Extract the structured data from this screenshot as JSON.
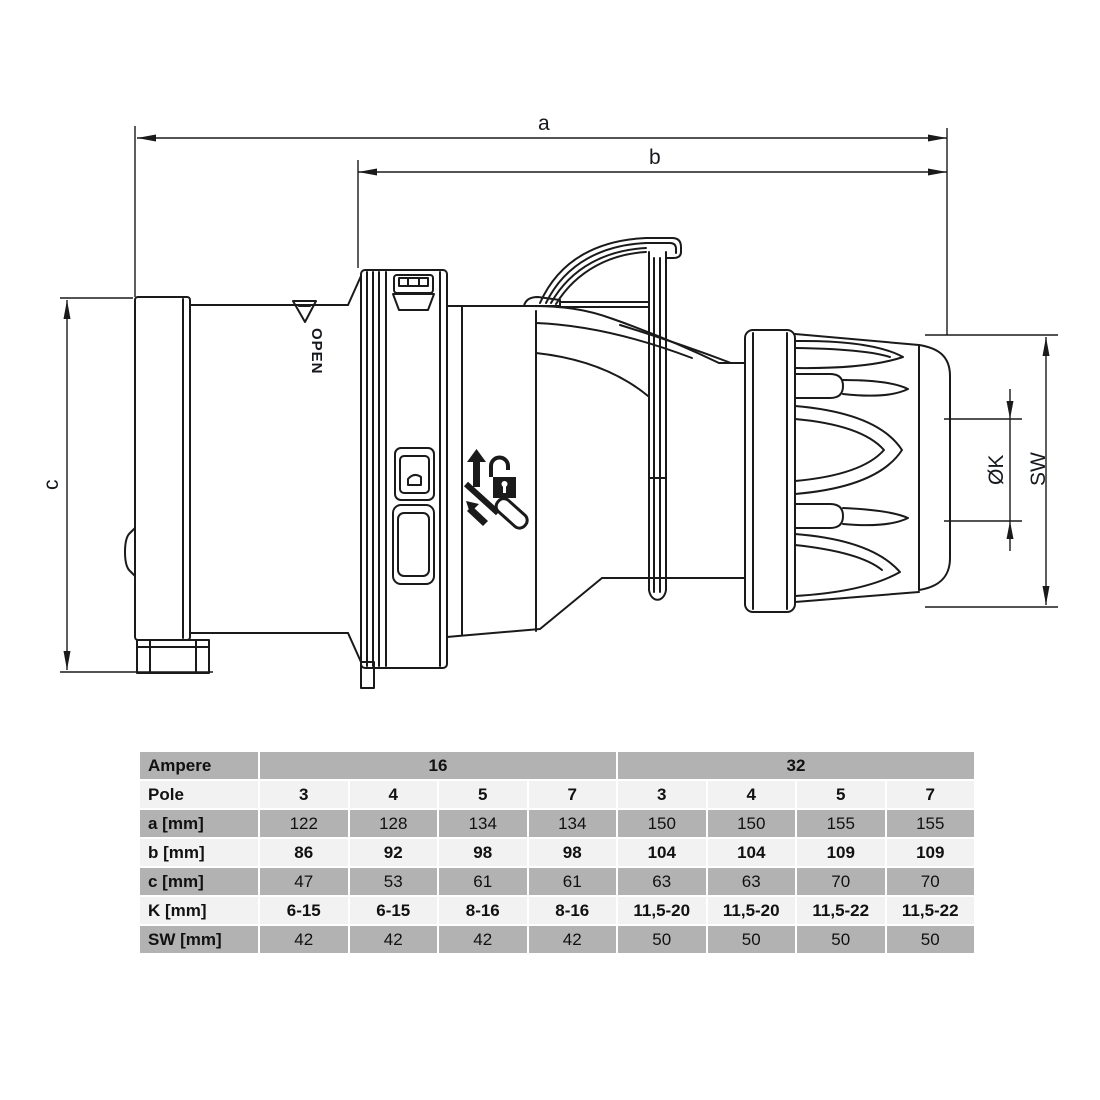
{
  "colors": {
    "line": "#1a1a1a",
    "table_row_dark": "#b2b2b2",
    "table_row_light": "#f2f2f2",
    "text": "#111111"
  },
  "drawing": {
    "dim_a": "a",
    "dim_b": "b",
    "dim_c": "c",
    "dim_k": "ØK",
    "dim_sw": "SW",
    "open_label": "OPEN",
    "icons": [
      "up-arrow-icon",
      "open-padlock-icon",
      "screwdriver-icon"
    ]
  },
  "table": {
    "ampere_row": {
      "label": "Ampere",
      "groups": [
        {
          "label": "16",
          "span": 4
        },
        {
          "label": "32",
          "span": 4
        }
      ]
    },
    "rows": [
      {
        "label": "Pole",
        "shade": "light",
        "values_bold": true,
        "values": [
          "3",
          "4",
          "5",
          "7",
          "3",
          "4",
          "5",
          "7"
        ]
      },
      {
        "label": "a [mm]",
        "shade": "dark",
        "values_bold": false,
        "values": [
          "122",
          "128",
          "134",
          "134",
          "150",
          "150",
          "155",
          "155"
        ]
      },
      {
        "label": "b [mm]",
        "shade": "light",
        "values_bold": true,
        "values": [
          "86",
          "92",
          "98",
          "98",
          "104",
          "104",
          "109",
          "109"
        ]
      },
      {
        "label": "c [mm]",
        "shade": "dark",
        "values_bold": false,
        "values": [
          "47",
          "53",
          "61",
          "61",
          "63",
          "63",
          "70",
          "70"
        ]
      },
      {
        "label": "K [mm]",
        "shade": "light",
        "values_bold": true,
        "values": [
          "6-15",
          "6-15",
          "8-16",
          "8-16",
          "11,5-20",
          "11,5-20",
          "11,5-22",
          "11,5-22"
        ]
      },
      {
        "label": "SW [mm]",
        "shade": "dark",
        "values_bold": false,
        "values": [
          "42",
          "42",
          "42",
          "42",
          "50",
          "50",
          "50",
          "50"
        ]
      }
    ]
  }
}
